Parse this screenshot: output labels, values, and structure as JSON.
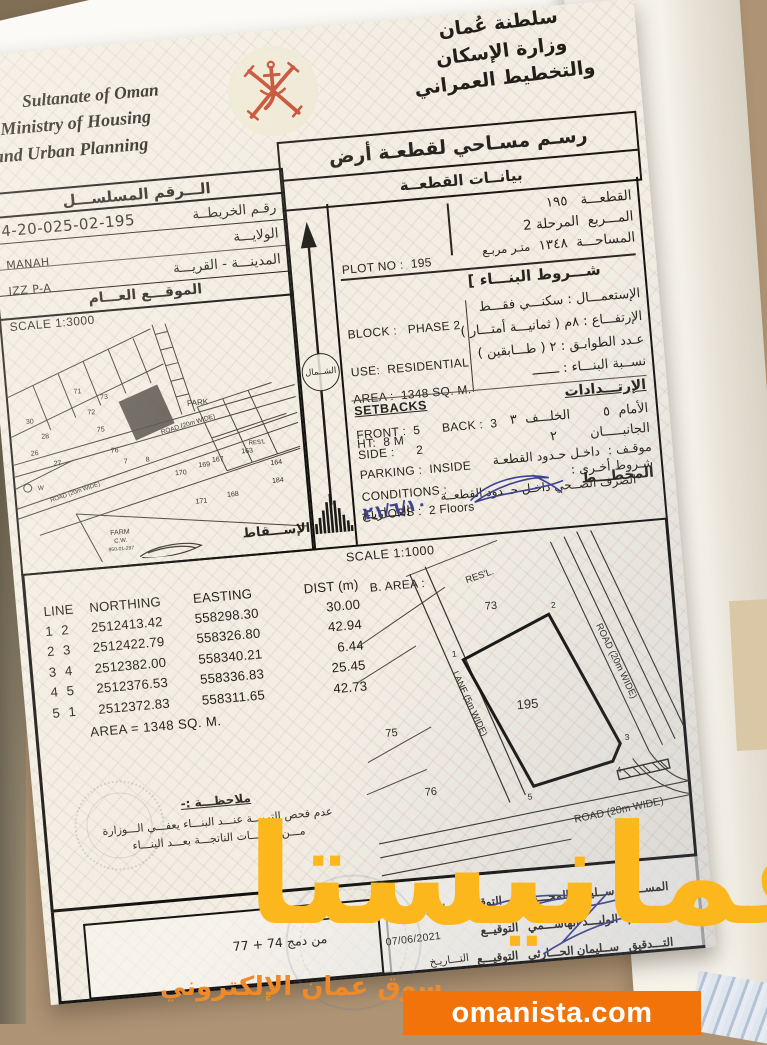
{
  "watermark": {
    "brand": "عمانيستا",
    "tagline": "سوق عمان الإلكتروني",
    "site": "omanista.com",
    "accent_color": "#fcb71c",
    "box_color": "#f2730a"
  },
  "header": {
    "en_line1": "Sultanate of Oman",
    "en_line2": "Ministry of Housing",
    "en_line3": "and Urban Planning",
    "ar_line1": "سلطنة عُمان",
    "ar_line2": "وزارة الإسكان",
    "ar_line3": "والتخطيط العمراني",
    "emblem": "oman-national-emblem",
    "emblem_color": "#c4492e"
  },
  "title_box": {
    "title": "رسـم مسـاحي لقطعـة أرض",
    "subtitle": "بيانــات القطعــة"
  },
  "serial": {
    "header": "الـــرقم المسلســـل",
    "value": "4-20-025-02-195",
    "map_no_label": "رقـم الخريطــة",
    "wilaya_label": "الولايـــة",
    "wilaya_value": "MANAH",
    "city_label": "المدينـــة - القريـــة",
    "city_value": "IZZ P-A",
    "location_label": "الموقـــع العـــام"
  },
  "location_map": {
    "scale": "SCALE 1:3000",
    "north": "الشــمال",
    "projection": "الإســـقاط",
    "park": "PARK",
    "farm_line1": "FARM",
    "farm_line2": "C.W.",
    "farm_line3": "950-01-297",
    "resl": "RES'L",
    "road": "ROAD (20m WIDE)",
    "well": "W",
    "plots": [
      "26",
      "27",
      "28",
      "30",
      "71",
      "72",
      "73",
      "75",
      "76",
      "78",
      "170",
      "163",
      "167",
      "169",
      "168",
      "171",
      "184",
      "164",
      "165",
      "195"
    ]
  },
  "plot_info": {
    "ar": {
      "plot_label": "القطعـــة",
      "plot_value": "١٩٥",
      "block_label": "المـــربع",
      "block_value": "المرحلة 2",
      "area_label": "المساحـــة",
      "area_value": "١٣٤٨",
      "area_unit": "متـر مربـع"
    },
    "en": {
      "plot": "PLOT NO :  195",
      "block": "BLOCK :   PHASE 2",
      "area": "AREA :  1348 SQ. M."
    }
  },
  "conditions": {
    "band": "شـــروط البنـــاء ]",
    "ar": {
      "use": "الإستعمـــال :  سكنـــي فقـــط",
      "height": "الإرتفـــاع :  ٨م  ( ثمانيـــة أمتـــار )",
      "floors": "عـدد الطوابـق :  ٢  ( طـــابقين )",
      "ratio": "نســبة البنـــاء :  ـــــــ",
      "setbacks": "الإرتـــدادات",
      "front_back": "الأمام  ٥        الخلـــف  ٣",
      "sides": "الجانبـــــان        ٢",
      "parking": "موقـف :  داخـل حـدود القطعـة",
      "other": "شـروط أخـرى :",
      "sewage": "الصرف الصــحي داخـل حــدود القطعــة",
      "planner": "المخطـــط",
      "date_label": "التـــاريـخ",
      "date_value": "٢١/٦/١٠"
    },
    "en": {
      "use": "USE:  RESIDENTIAL",
      "height": "HT:  8 M",
      "floors": "FLOORS :  2 Floors",
      "barea": "B. AREA :",
      "setbacks": "SETBACKS",
      "front_back": "FRONT :  5      BACK :  3",
      "side": "SIDE :      2",
      "parking": "PARKING :  INSIDE",
      "conditions": "CONDITIONS :"
    }
  },
  "survey": {
    "scale": "SCALE 1:1000",
    "table": {
      "h_line": "LINE",
      "h_northing": "NORTHING",
      "h_easting": "EASTING",
      "h_dist": "DIST (m)",
      "rows": [
        [
          "1",
          "2",
          "2512413.42",
          "558298.30",
          "30.00"
        ],
        [
          "2",
          "3",
          "2512422.79",
          "558326.80",
          "42.94"
        ],
        [
          "3",
          "4",
          "2512382.00",
          "558340.21",
          "6.44"
        ],
        [
          "4",
          "5",
          "2512376.53",
          "558336.83",
          "25.45"
        ],
        [
          "5",
          "1",
          "2512372.83",
          "558311.65",
          "42.73"
        ]
      ],
      "area": "AREA = 1348 SQ. M."
    },
    "drawing": {
      "plot": "195",
      "n73": "73",
      "n75": "75",
      "n76": "76",
      "resl": "RES'L.",
      "lane": "LANE (5m WIDE)",
      "road_right": "ROAD (20m WIDE)",
      "road_bottom": "ROAD (20m WIDE)",
      "v1": "1",
      "v2": "2",
      "v3": "3",
      "v4": "4",
      "v5": "5"
    },
    "note": {
      "title": "ملاحظـــة :-",
      "line1": "عدم فحص التربـــة عنـــد البنـــاء يعفـــي الـــوزارة",
      "line2": "مـــن التبعـــات الناتجـــة بعـــد البنـــاء"
    }
  },
  "notes_box": {
    "label": "الملاحظــات :",
    "value": "من دمج 74 + 77"
  },
  "signatures": {
    "rows": [
      {
        "role": "المســـاح",
        "name": "ســليمان المحـــروقي",
        "sig": "التوقيـــــع",
        "date_label": "التـــاريـخ",
        "date": "07/06/2021"
      },
      {
        "role": "الرســـام",
        "name": "الوليـــد الهاشـــمي",
        "sig": "التوقيــع",
        "date_label": "",
        "date": "07/06/2021"
      },
      {
        "role": "التـــدقيق",
        "name": "ســليمان الحـــارثي",
        "sig": "التوقيـــع",
        "date_label": "التـــاريـخ",
        "date": ""
      }
    ]
  }
}
